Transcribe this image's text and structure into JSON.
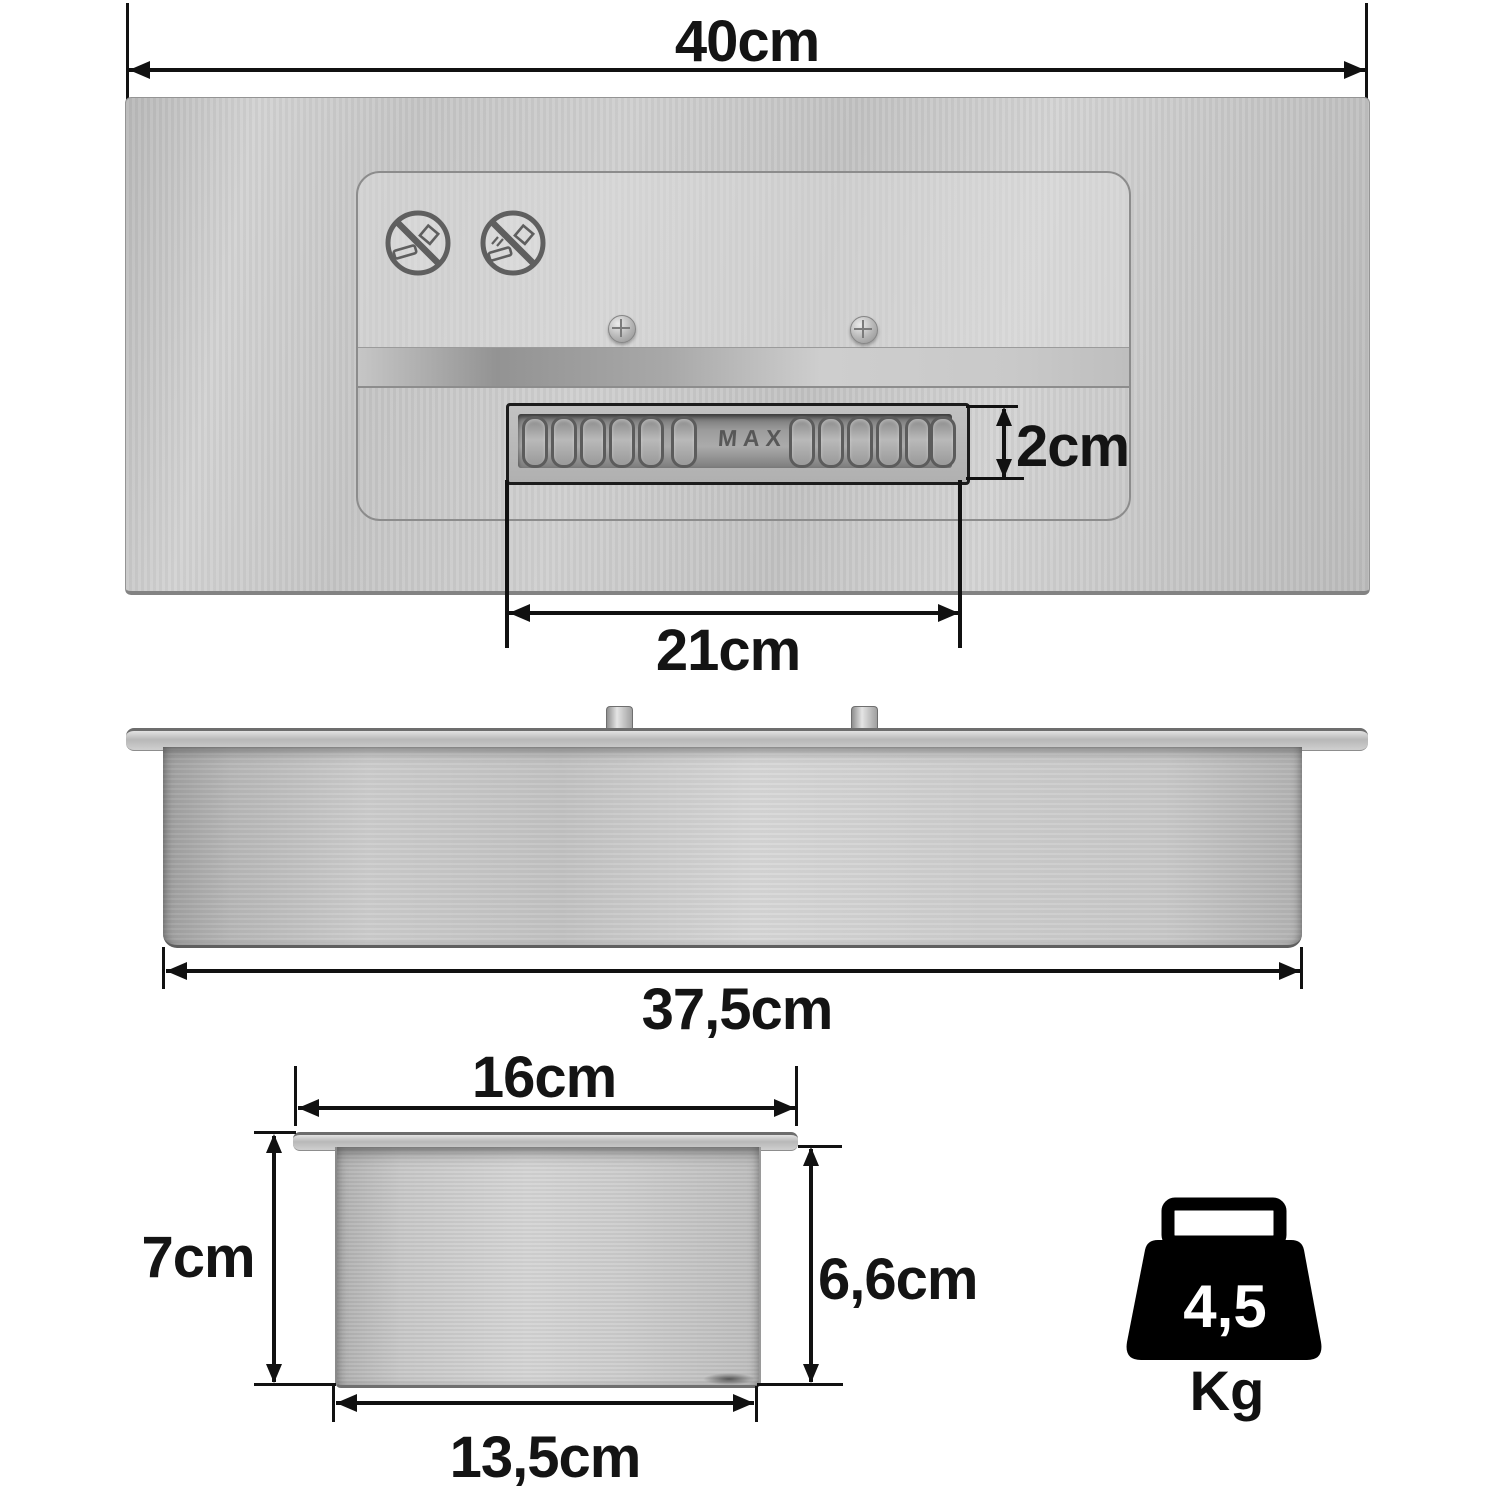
{
  "labels": {
    "top_width": "40cm",
    "slot_height": "2cm",
    "slot_length": "21cm",
    "side_width": "37,5cm",
    "end_flange_width": "16cm",
    "end_total_height": "7cm",
    "end_body_height": "6,6cm",
    "end_body_width": "13,5cm"
  },
  "markings": {
    "max": "MAX"
  },
  "weight": {
    "value": "4,5",
    "unit": "Kg"
  },
  "icons": {
    "warning_left": "no-smoking-prohibition",
    "warning_right": "no-open-flame-prohibition",
    "weight": "kettlebell-weight"
  },
  "colors": {
    "dimension_ink": "#111111",
    "label_ink": "#141414",
    "steel_light": "#d6d6d6",
    "steel_mid": "#c3c3c3",
    "steel_dark": "#8f8f8f",
    "slot_frame": "#1c1c1c",
    "weight_icon_fill": "#000000"
  }
}
